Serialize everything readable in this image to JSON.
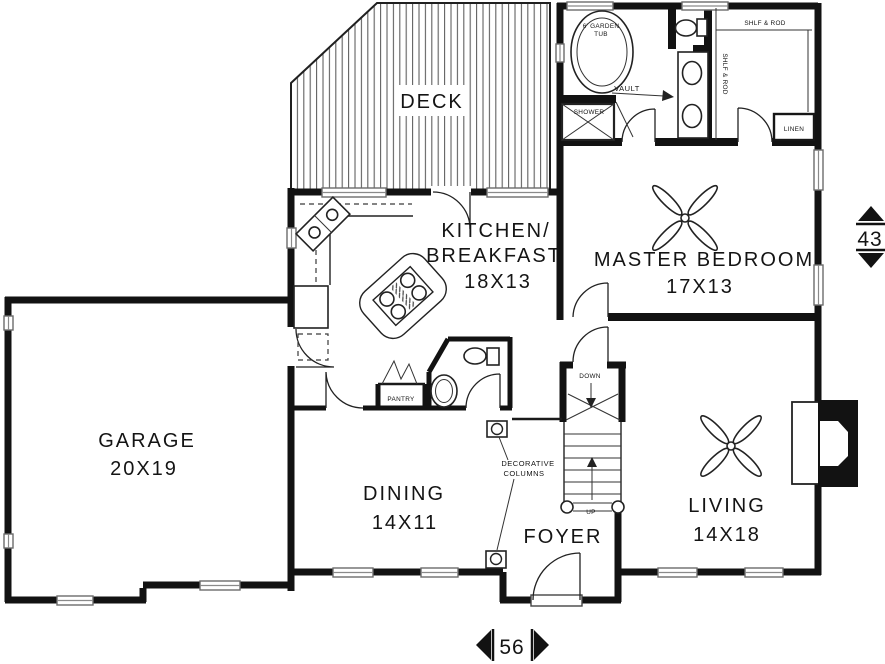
{
  "rooms": {
    "deck": {
      "name": "DECK"
    },
    "kitchen_breakfast": {
      "name_line1": "KITCHEN/",
      "name_line2": "BREAKFAST",
      "size": "18X13"
    },
    "master_bedroom": {
      "name": "MASTER BEDROOM",
      "size": "17X13"
    },
    "garage": {
      "name": "GARAGE",
      "size": "20X19"
    },
    "dining": {
      "name": "DINING",
      "size": "14X11"
    },
    "living": {
      "name": "LIVING",
      "size": "14X18"
    },
    "foyer": {
      "name": "FOYER"
    }
  },
  "labels": {
    "garden_tub_l1": "6' GARDEN",
    "garden_tub_l2": "TUB",
    "shower": "SHOWER",
    "vault": "VAULT",
    "shelf_rod_closet_top": "SHLF & ROD",
    "shelf_rod_closet_side": "SHLF & ROD",
    "linen": "LINEN",
    "pantry": "PANTRY",
    "stairs_down": "DOWN",
    "stairs_up": "UP",
    "decorative_columns_l1": "DECORATIVE",
    "decorative_columns_l2": "COLUMNS"
  },
  "dimensions": {
    "overall_width": "56",
    "overall_depth": "43"
  },
  "colors": {
    "wall": "#121212",
    "window": "#6b6b6b",
    "deck_stripe": "#5f5f5f",
    "background": "#ffffff"
  }
}
